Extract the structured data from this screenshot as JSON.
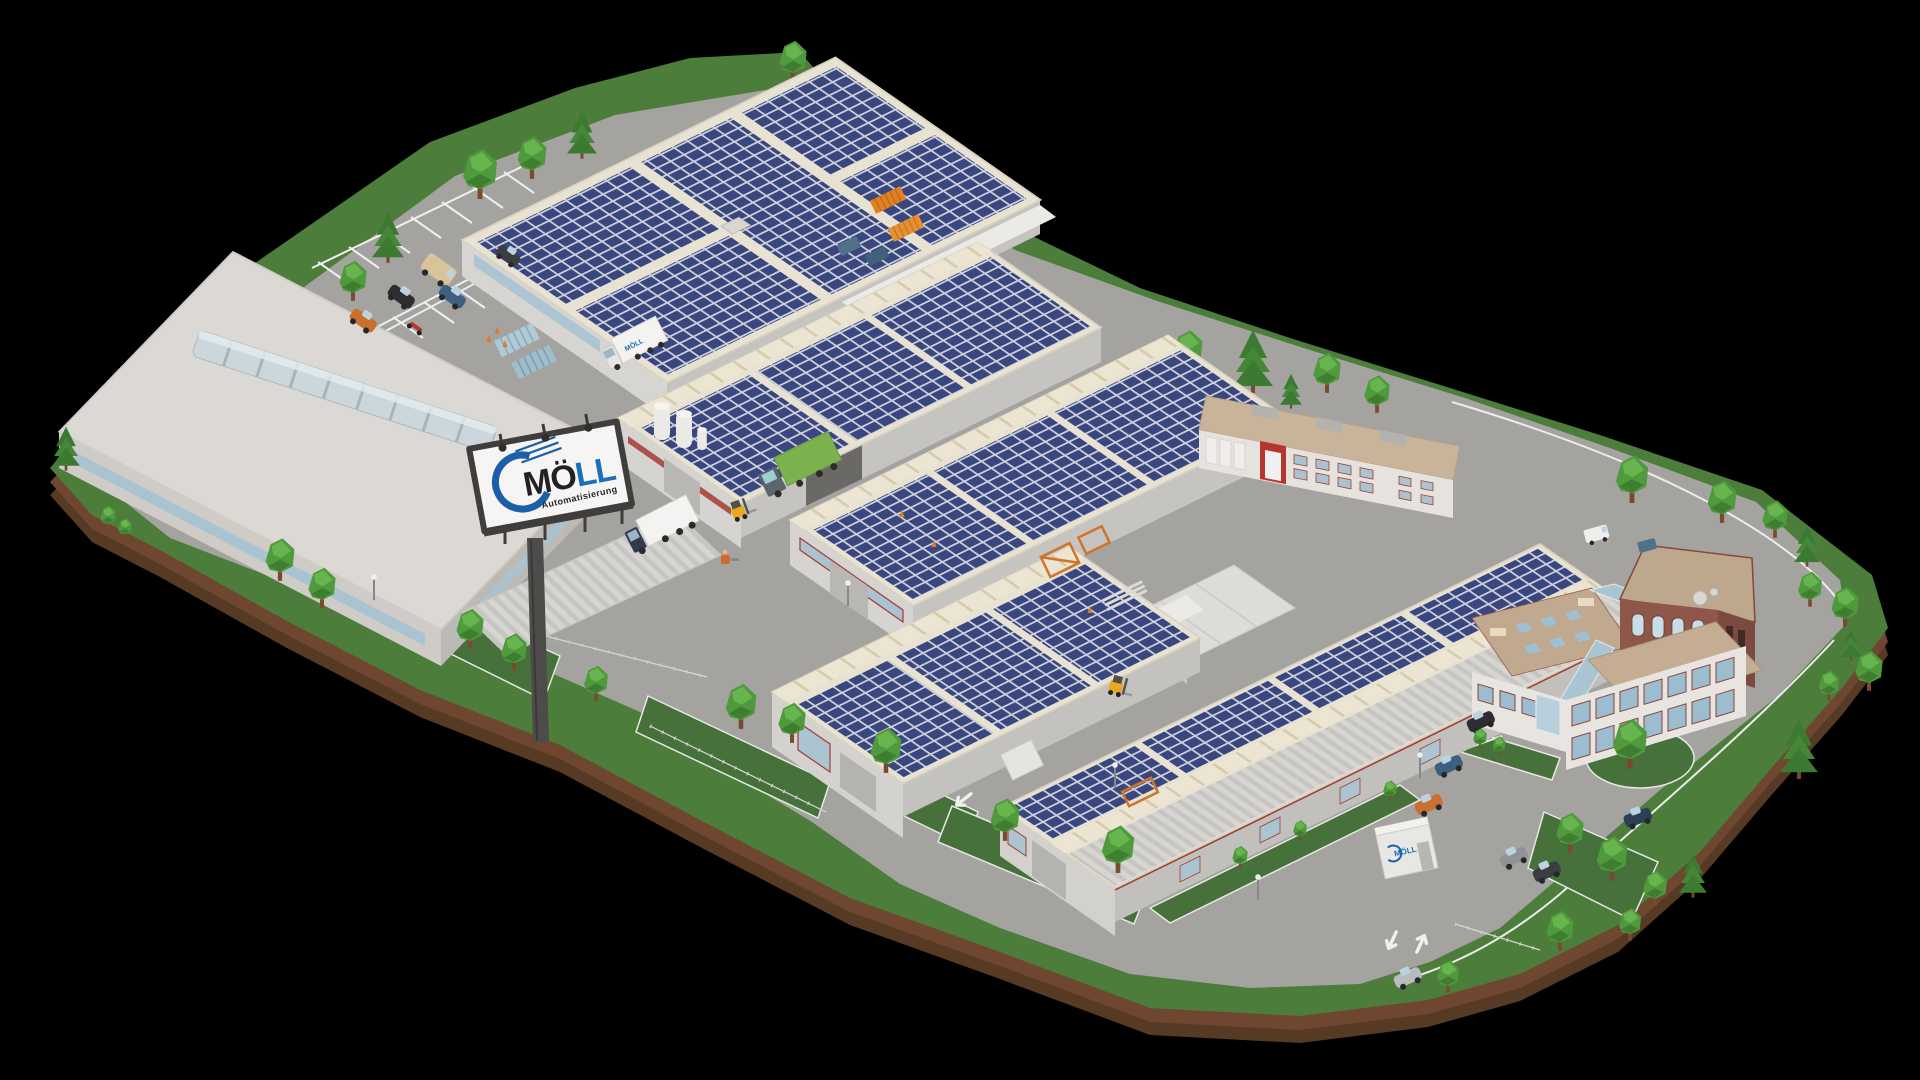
{
  "scene": {
    "type": "3D rendered aerial site overview (diorama on black background)",
    "company": "MÖLL Automatisierung",
    "background_color": "#000000",
    "terrain": {
      "grass": "#4c7d3b",
      "earth_edge": "#6f4328",
      "asphalt": "#a5a3a0",
      "road_marking": "#f0f0ee"
    }
  },
  "brand": {
    "name": "MÖLL",
    "subtitle": "Automatisierung",
    "accent_blue": "#1a6fba",
    "swoosh_blue": "#1a5fa8",
    "dark_text": "#212126"
  },
  "billboard": {
    "name_dark": "MÖ",
    "name_accent": "LL",
    "subtitle": "Automatisierung"
  },
  "buildings": [
    {
      "name": "north-production-hall",
      "roof": "solar-panel-array",
      "features": [
        "loading-dock-canopy",
        "rooftop-vent"
      ]
    },
    {
      "name": "west-warehouse",
      "roof": "light-metal-with-barrel-skylight",
      "features": [
        "blue-window-band"
      ]
    },
    {
      "name": "center-hall-a",
      "roof": "solar-panel-array",
      "features": [
        "barrel-skylights",
        "truck-loading-bay"
      ]
    },
    {
      "name": "center-hall-b",
      "roof": "solar-panel-array",
      "features": [
        "barrel-skylights"
      ]
    },
    {
      "name": "south-hall",
      "roof": "solar-panel-array",
      "features": [
        "barrel-skylights",
        "loading-canopy",
        "gable-window"
      ]
    },
    {
      "name": "long-east-hall",
      "roof": "solar-panel-array-with-ribbed-south-slope",
      "features": [
        "barrel-skylight-ridge"
      ]
    },
    {
      "name": "rear-annex",
      "roof": "flat-tan",
      "features": [
        "red-entrance-portal",
        "rooftop-hvac-units",
        "red-framed-windows"
      ]
    },
    {
      "name": "tent-warehouse",
      "roof": "white-tarp"
    },
    {
      "name": "office-building",
      "roof": "flat-tan",
      "features": [
        "glass-atrium",
        "satellite-dishes",
        "brick-tower",
        "red-framed-windows",
        "roof-skylights"
      ]
    },
    {
      "name": "parking-canopy",
      "roof": "ribbed-metal"
    },
    {
      "name": "gatehouse-container",
      "label": "MÖLL"
    }
  ],
  "vehicles": [
    {
      "type": "box-truck",
      "color": "white",
      "label": "MÖLL",
      "location": "north-hall-dock"
    },
    {
      "type": "box-truck",
      "color": "white",
      "location": "west-yard"
    },
    {
      "type": "semi-truck",
      "color": "green",
      "location": "center-hall-loading-bay"
    },
    {
      "type": "van",
      "color": "beige",
      "location": "north-parking"
    },
    {
      "type": "car",
      "color": "black",
      "location": "north-parking"
    },
    {
      "type": "car",
      "color": "blue",
      "location": "north-parking"
    },
    {
      "type": "car",
      "color": "orange",
      "location": "north-parking"
    },
    {
      "type": "car",
      "color": "dark-gray",
      "location": "north-parking"
    },
    {
      "type": "motorcycle",
      "color": "red",
      "location": "north-parking"
    },
    {
      "type": "forklift",
      "color": "yellow",
      "location": "center-yard"
    },
    {
      "type": "forklift",
      "color": "yellow",
      "location": "east-courtyard"
    },
    {
      "type": "pallet-truck",
      "color": "orange",
      "location": "west-yard"
    },
    {
      "type": "car",
      "color": "black",
      "location": "east-parking"
    },
    {
      "type": "car",
      "color": "blue",
      "location": "east-parking"
    },
    {
      "type": "car",
      "color": "orange",
      "location": "east-parking"
    },
    {
      "type": "car",
      "color": "silver",
      "location": "east-parking"
    },
    {
      "type": "car",
      "color": "dark-gray",
      "location": "east-parking"
    },
    {
      "type": "car",
      "color": "navy",
      "location": "east-parking-island"
    },
    {
      "type": "van",
      "color": "white",
      "location": "office-rear"
    }
  ],
  "site_features": {
    "solar_panel_color": "#3a477e",
    "skylight_color": "#c9d6dc",
    "containers": [
      {
        "color": "light-blue",
        "count": 2
      },
      {
        "color": "orange",
        "count": 2
      }
    ],
    "dumpsters": {
      "color": "steel-blue",
      "count": 2
    },
    "silos": 3,
    "road_arrows": [
      "down-left",
      "up-right",
      "down-left",
      "up-right"
    ],
    "trees": {
      "deciduous": 39,
      "conifer": 11
    },
    "street_lights": 5,
    "fences": 4
  }
}
